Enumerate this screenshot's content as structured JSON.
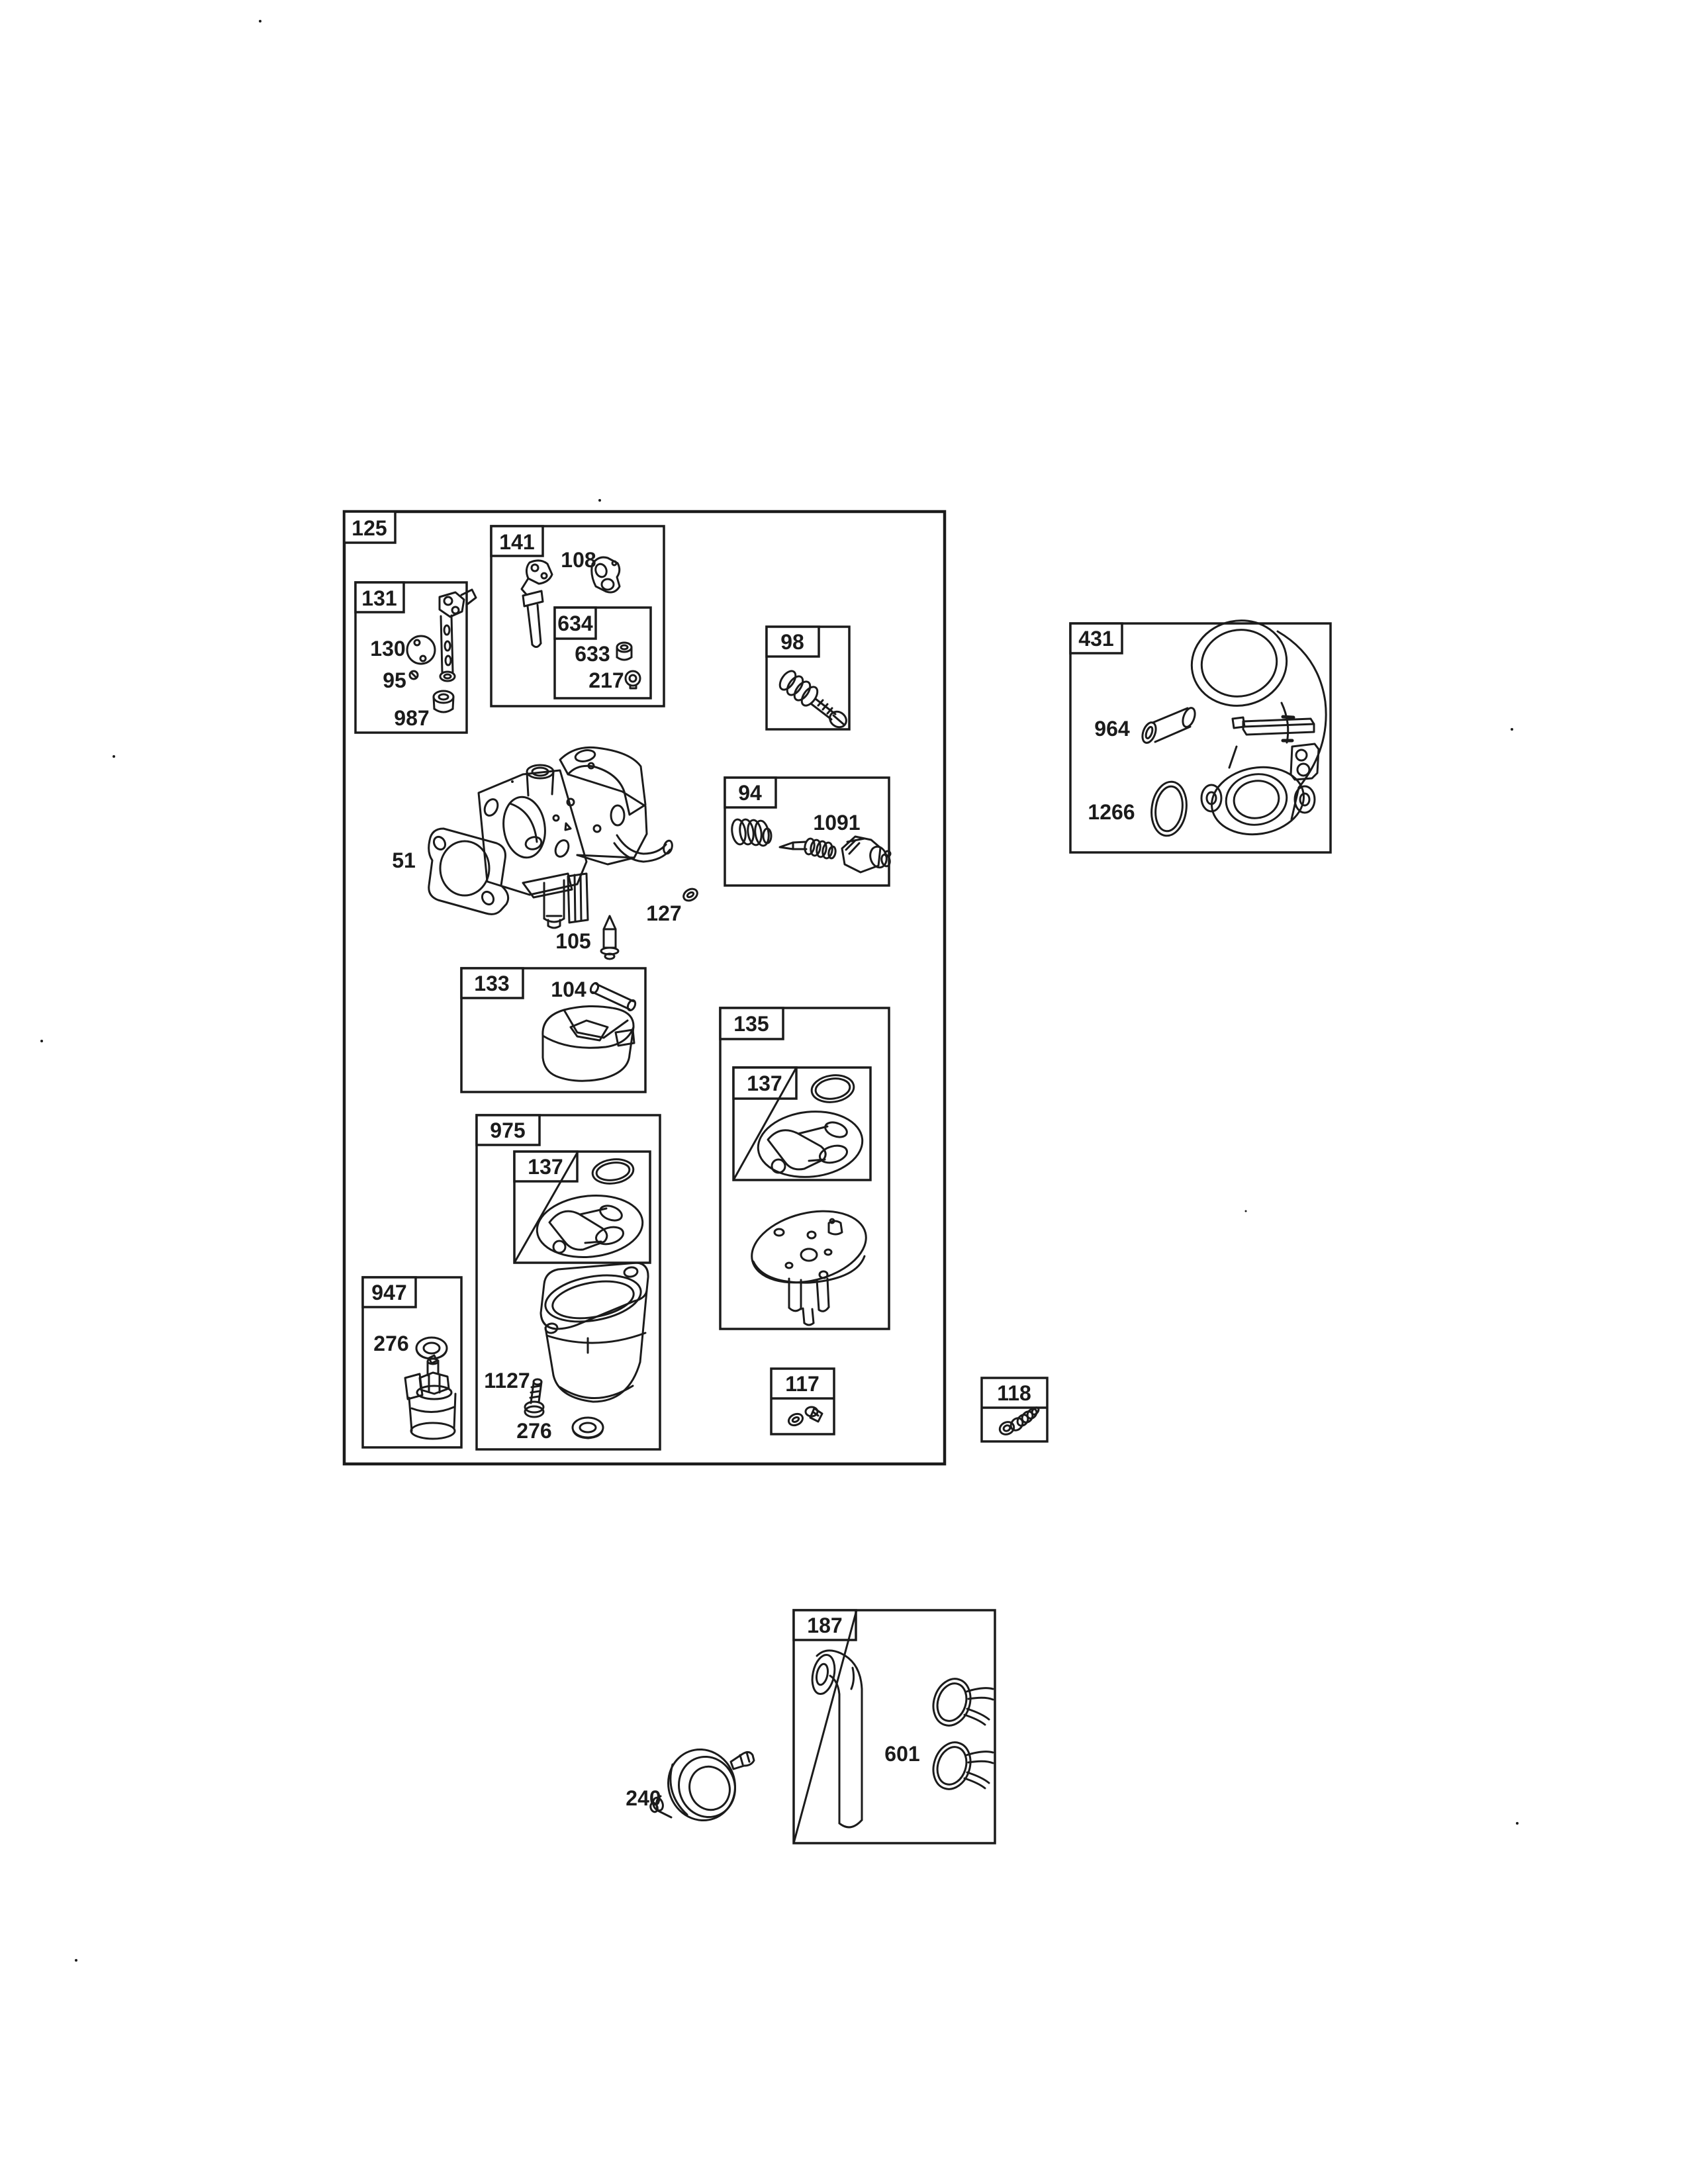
{
  "colors": {
    "ink": "#1b1b1b",
    "paper": "#ffffff"
  },
  "labels": {
    "b125": "125",
    "b131": "131",
    "b141": "141",
    "b634": "634",
    "b98": "98",
    "b94": "94",
    "b431": "431",
    "b133": "133",
    "b135": "135",
    "b137a": "137",
    "b975": "975",
    "b137b": "137",
    "b947": "947",
    "b117": "117",
    "b118": "118",
    "b187": "187",
    "p108": "108",
    "p633": "633",
    "p217": "217",
    "p130": "130",
    "p95": "95",
    "p987": "987",
    "p1091": "1091",
    "p964": "964",
    "p1266": "1266",
    "p51": "51",
    "p127": "127",
    "p105": "105",
    "p104": "104",
    "p1127": "1127",
    "p276_bowl": "276",
    "p276_solenoid": "276",
    "p601": "601",
    "p240": "240"
  }
}
